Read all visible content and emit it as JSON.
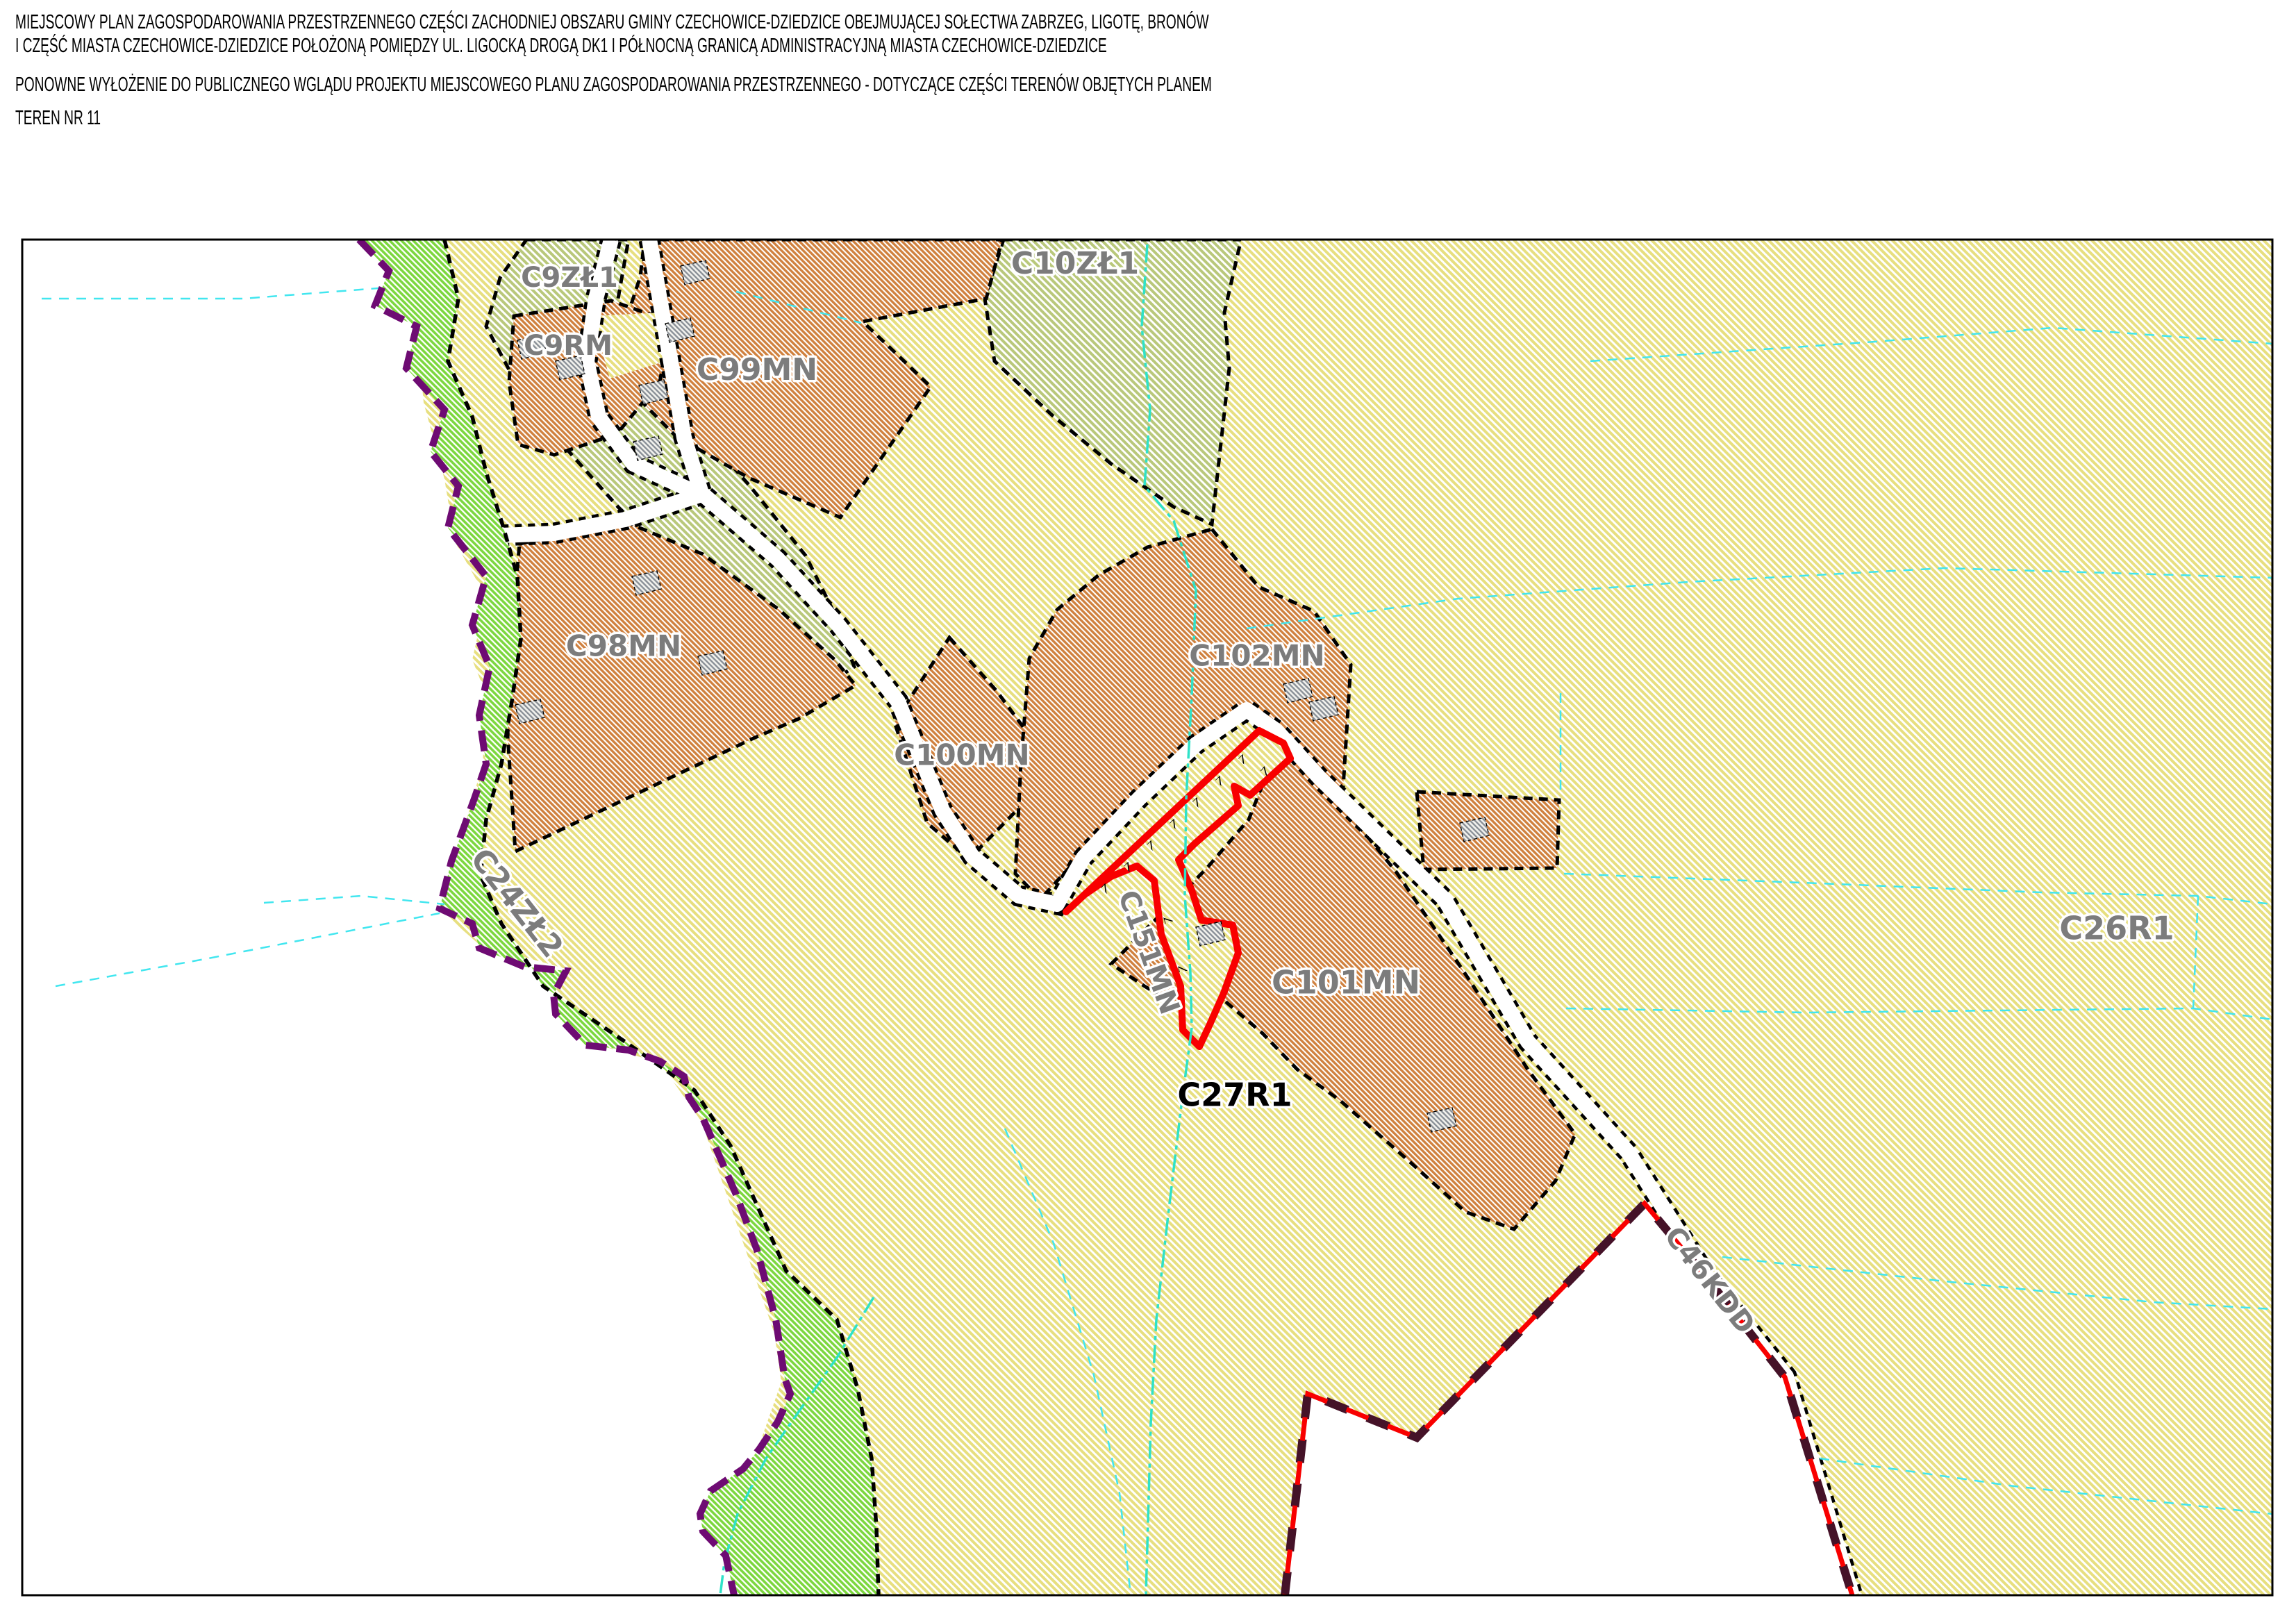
{
  "header": {
    "title_line1": "MIEJSCOWY PLAN ZAGOSPODAROWANIA PRZESTRZENNEGO CZĘŚCI ZACHODNIEJ OBSZARU GMINY CZECHOWICE-DZIEDZICE OBEJMUJĄCEJ SOŁECTWA ZABRZEG, LIGOTĘ, BRONÓW",
    "title_line2": "I CZĘŚĆ MIASTA CZECHOWICE-DZIEDZICE POŁOŻONĄ POMIĘDZY UL. LIGOCKĄ DROGĄ DK1 I PÓŁNOCNĄ GRANICĄ ADMINISTRACYJNĄ MIASTA CZECHOWICE-DZIEDZICE",
    "subtitle": "PONOWNE WYŁOŻENIE DO PUBLICZNEGO WGLĄDU PROJEKTU MIEJSCOWEGO PLANU ZAGOSPODAROWANIA PRZESTRZENNEGO - DOTYCZĄCE CZĘŚCI TERENÓW OBJĘTYCH PLANEM",
    "teren": "TEREN NR 11"
  },
  "map": {
    "labels": [
      {
        "text": "C9ZŁ1",
        "color": "#7c7c7c"
      },
      {
        "text": "C9RM",
        "color": "#7c7c7c"
      },
      {
        "text": "C99MN",
        "color": "#7c7c7c"
      },
      {
        "text": "C10ZŁ1",
        "color": "#7c7c7c"
      },
      {
        "text": "C98MN",
        "color": "#7c7c7c"
      },
      {
        "text": "C100MN",
        "color": "#7c7c7c"
      },
      {
        "text": "C102MN",
        "color": "#7c7c7c"
      },
      {
        "text": "C151MN",
        "color": "#7c7c7c"
      },
      {
        "text": "C101MN",
        "color": "#7c7c7c"
      },
      {
        "text": "C27R1",
        "color": "#000000"
      },
      {
        "text": "C26R1",
        "color": "#7c7c7c"
      },
      {
        "text": "C24ZŁ2",
        "color": "#7c7c7c"
      },
      {
        "text": "C46KDD",
        "color": "#7c7c7c"
      }
    ],
    "colors": {
      "agriculture_cream": "#e9e180",
      "meadow_olive": "#b9c87b",
      "green_strip": "#7cd73e",
      "residential_orange": "#d0813e",
      "road_white": "#ffffff",
      "zone_boundary": "#000000",
      "admin_boundary_purple": "#6e0b73",
      "exposure_boundary_red": "#f80000",
      "plan_boundary_maroon": "#451228",
      "stream_turquoise": "#2fe2c8",
      "parcel_cyan": "#41e6ef",
      "subject_outline_red": "#f80000"
    }
  }
}
